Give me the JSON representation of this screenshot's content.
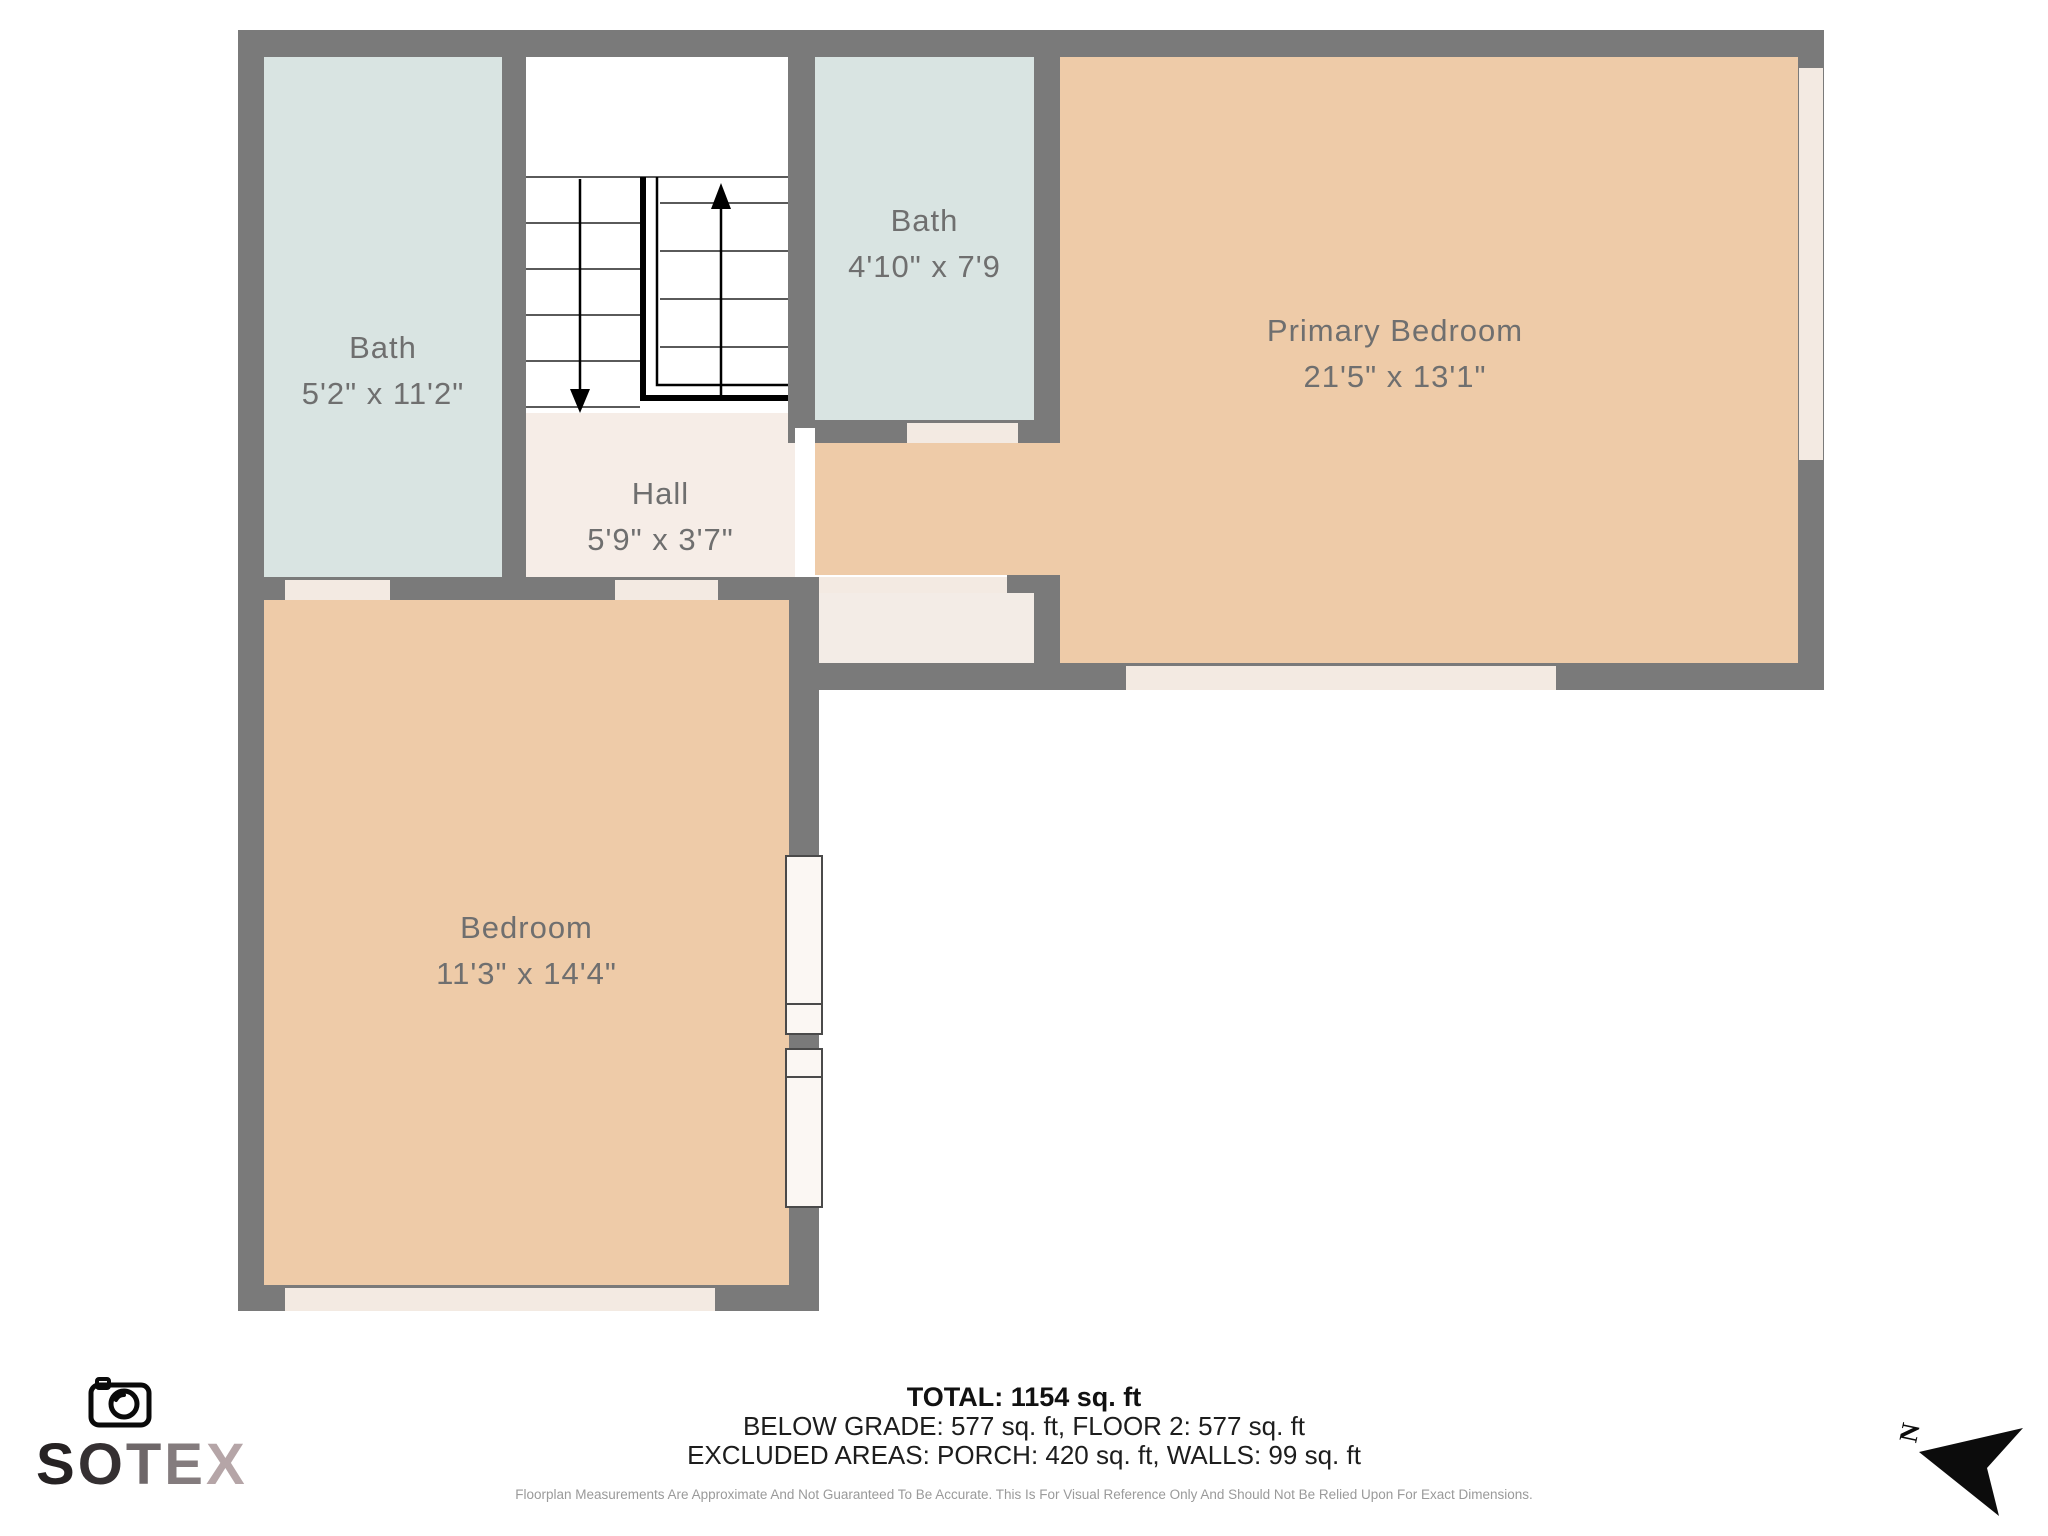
{
  "plan": {
    "rooms": {
      "bath1": {
        "name": "Bath",
        "dims": "5'2\" x 11'2\""
      },
      "bath2": {
        "name": "Bath",
        "dims": "4'10\" x 7'9"
      },
      "hall": {
        "name": "Hall",
        "dims": "5'9\" x 3'7\""
      },
      "primary_bedroom": {
        "name": "Primary Bedroom",
        "dims": "21'5\" x 13'1\""
      },
      "bedroom": {
        "name": "Bedroom",
        "dims": "11'3\" x 14'4\""
      }
    },
    "north_label": "N"
  },
  "footer": {
    "total": "TOTAL: 1154 sq. ft",
    "floors": "BELOW GRADE: 577 sq. ft, FLOOR 2: 577 sq. ft",
    "excluded": "EXCLUDED AREAS: PORCH: 420 sq. ft, WALLS: 99 sq. ft",
    "disclaimer": "Floorplan Measurements Are Approximate And Not Guaranteed To Be Accurate. This Is For Visual Reference Only And Should Not Be Relied Upon For Exact Dimensions."
  },
  "logo": {
    "letters": [
      "S",
      "O",
      "T",
      "E",
      "X"
    ]
  },
  "colors": {
    "wall": "#7a7a7a",
    "bath": "#d9e4e2",
    "room": "#eecba8",
    "hall": "#f6ede7",
    "closet": "#f3ece6",
    "opening": "#f3eae2",
    "label": "#6f6f6f"
  }
}
